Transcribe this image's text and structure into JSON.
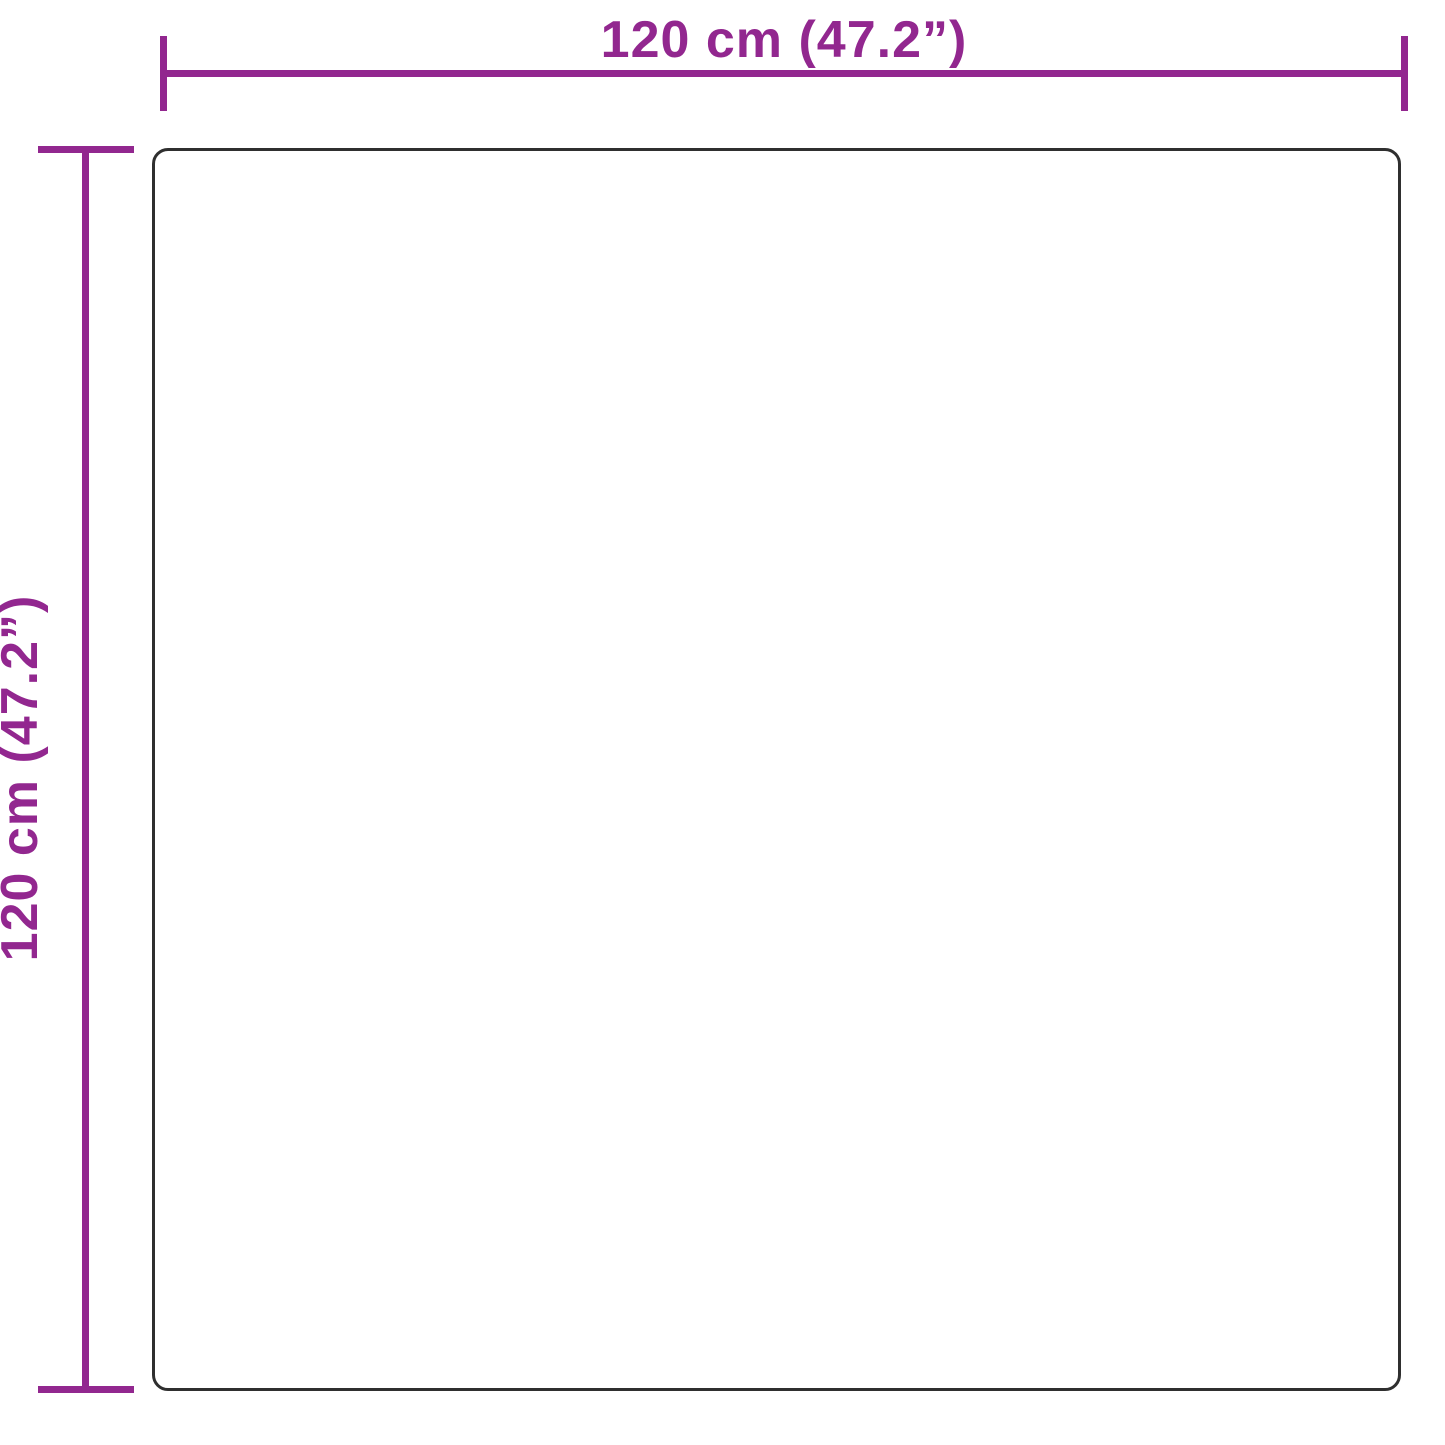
{
  "diagram": {
    "type": "product-dimension-diagram",
    "shape": "square-with-rounded-corners",
    "width_label": "120 cm (47.2”)",
    "height_label": "120 cm (47.2”)"
  },
  "colors": {
    "dimension": "#92278F",
    "outline": "#2f2f2f",
    "background": "#ffffff"
  }
}
